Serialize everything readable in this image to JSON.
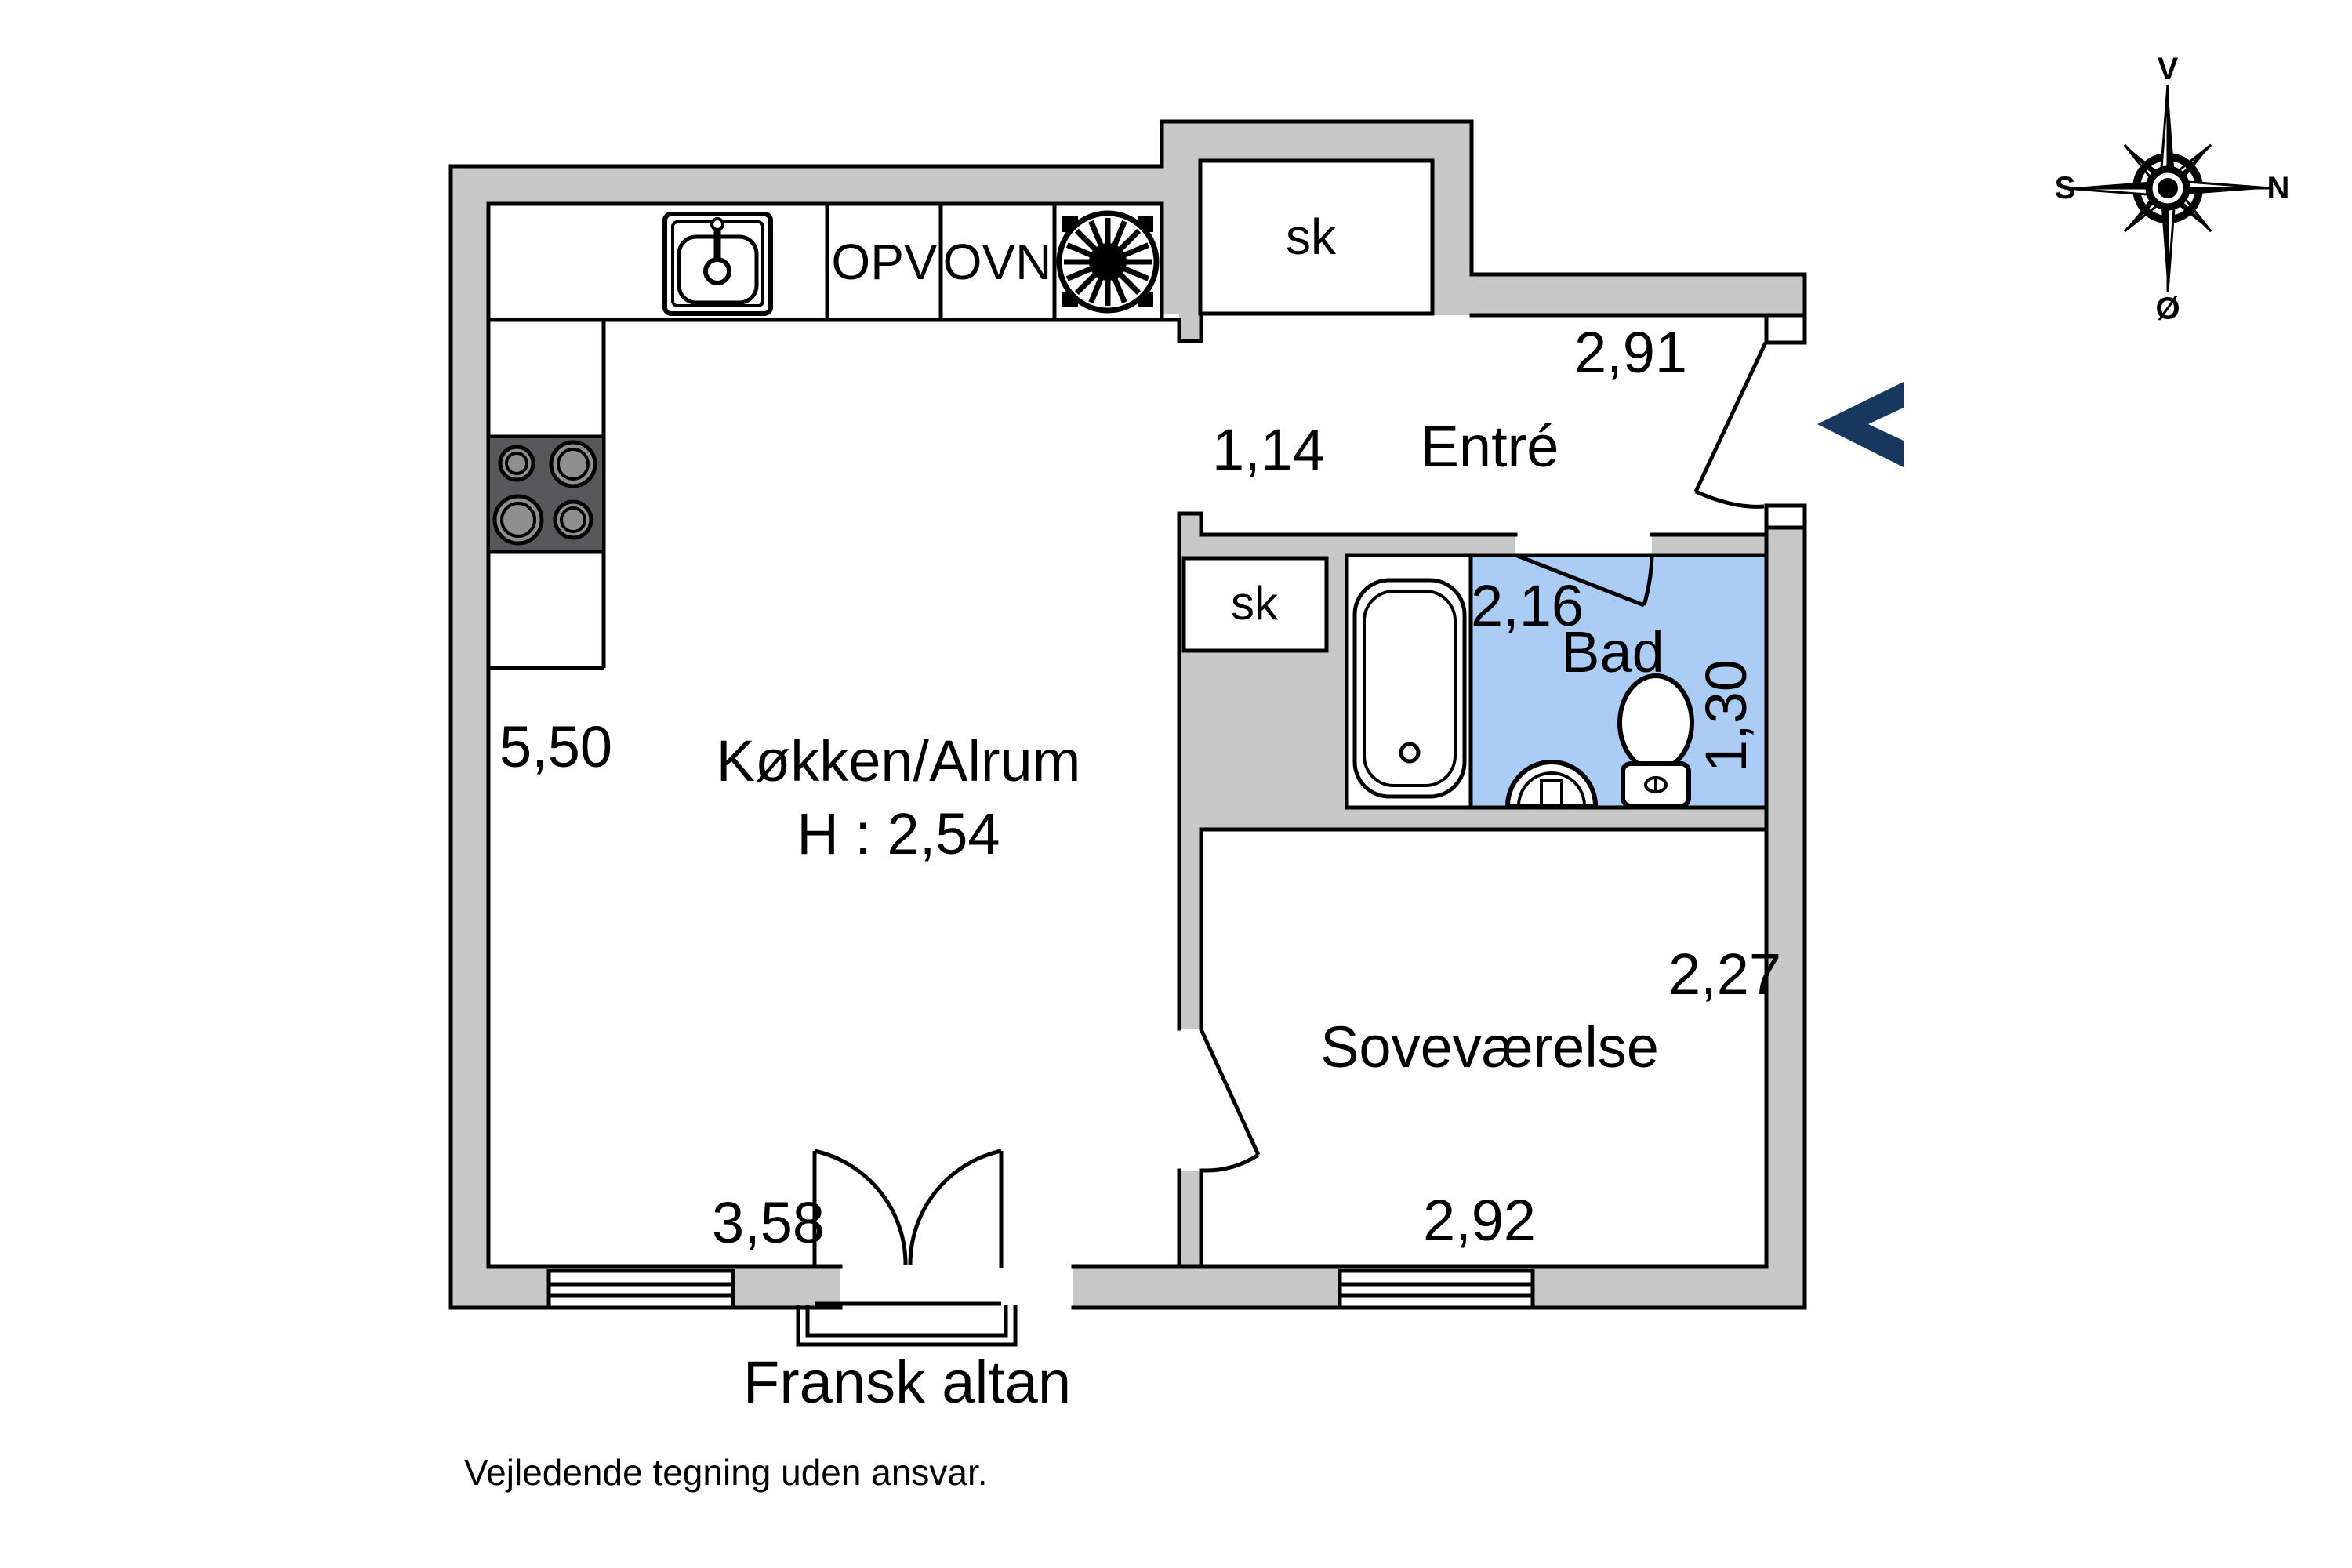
{
  "title": "Floor plan",
  "colors": {
    "background": "#ffffff",
    "wall": "#c8c8c8",
    "line": "#000000",
    "bathroom": "#abccf4",
    "stove": "#58585b",
    "burner": "#8f8f8f",
    "arrow": "#17375e"
  },
  "rooms": {
    "kitchen": {
      "name": "Køkken/Alrum",
      "ceiling_height": "H : 2,54",
      "width": "5,50",
      "length": "3,58"
    },
    "entry": {
      "name": "Entré",
      "width": "1,14",
      "length": "2,91"
    },
    "bath": {
      "name": "Bad",
      "width": "2,16",
      "depth": "1,30"
    },
    "bedroom": {
      "name": "Soveværelse",
      "width": "2,92",
      "depth": "2,27"
    },
    "closet_top": {
      "name": "sk"
    },
    "closet_hall": {
      "name": "sk"
    }
  },
  "appliances": {
    "dishwasher": "OPV",
    "oven": "OVN"
  },
  "balcony": {
    "label": "Fransk altan"
  },
  "disclaimer": "Vejledende tegning uden ansvar.",
  "compass": {
    "west": "V",
    "north": "N",
    "east": "Ø",
    "south": "S"
  }
}
